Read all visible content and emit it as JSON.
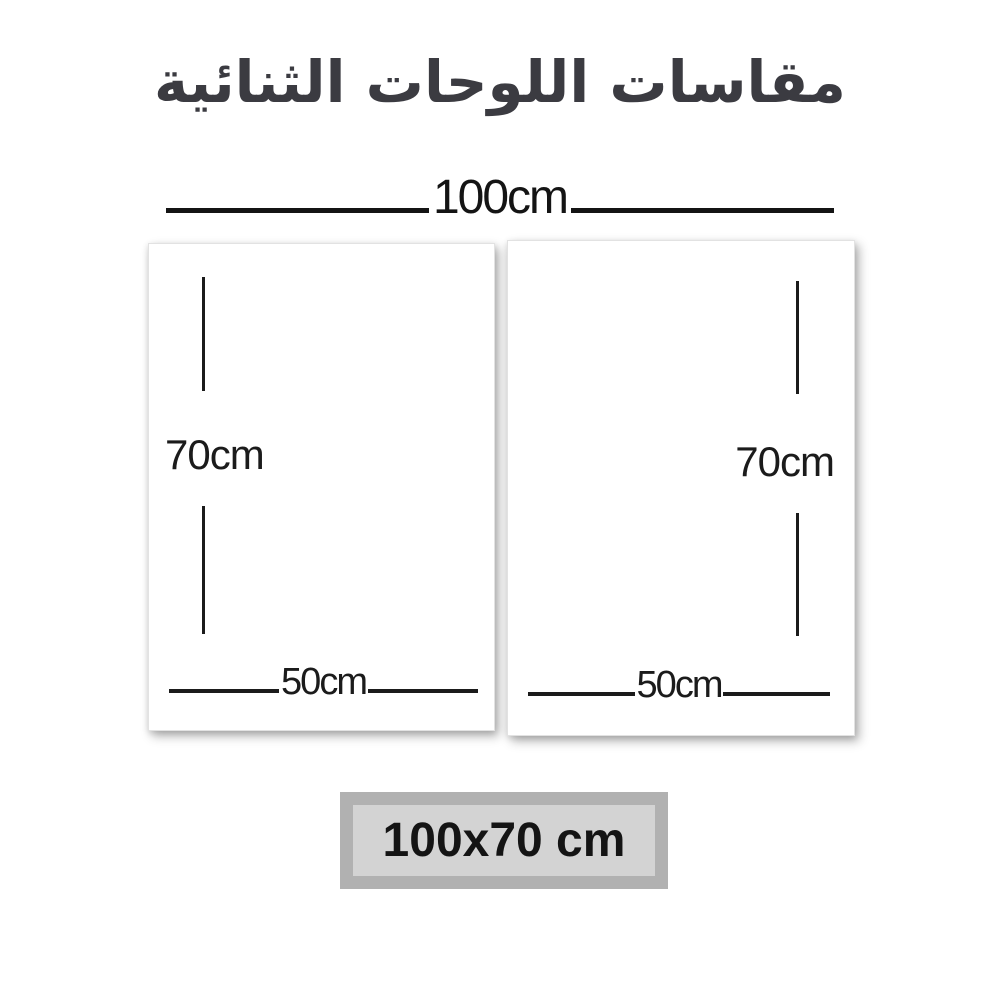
{
  "title": "مقاسات اللوحات الثنائية",
  "total_width_label": "100cm",
  "panels": [
    {
      "name": "left",
      "height_label": "70cm",
      "width_label": "50cm"
    },
    {
      "name": "right",
      "height_label": "70cm",
      "width_label": "50cm"
    }
  ],
  "size_badge_label": "100x70 cm",
  "colors": {
    "background": "#ffffff",
    "title_text": "#3b3b41",
    "dimension_lines": "#1b1b1b",
    "badge_frame": "#b1b1b1",
    "badge_inner": "#d3d3d3",
    "badge_text": "#141414"
  }
}
